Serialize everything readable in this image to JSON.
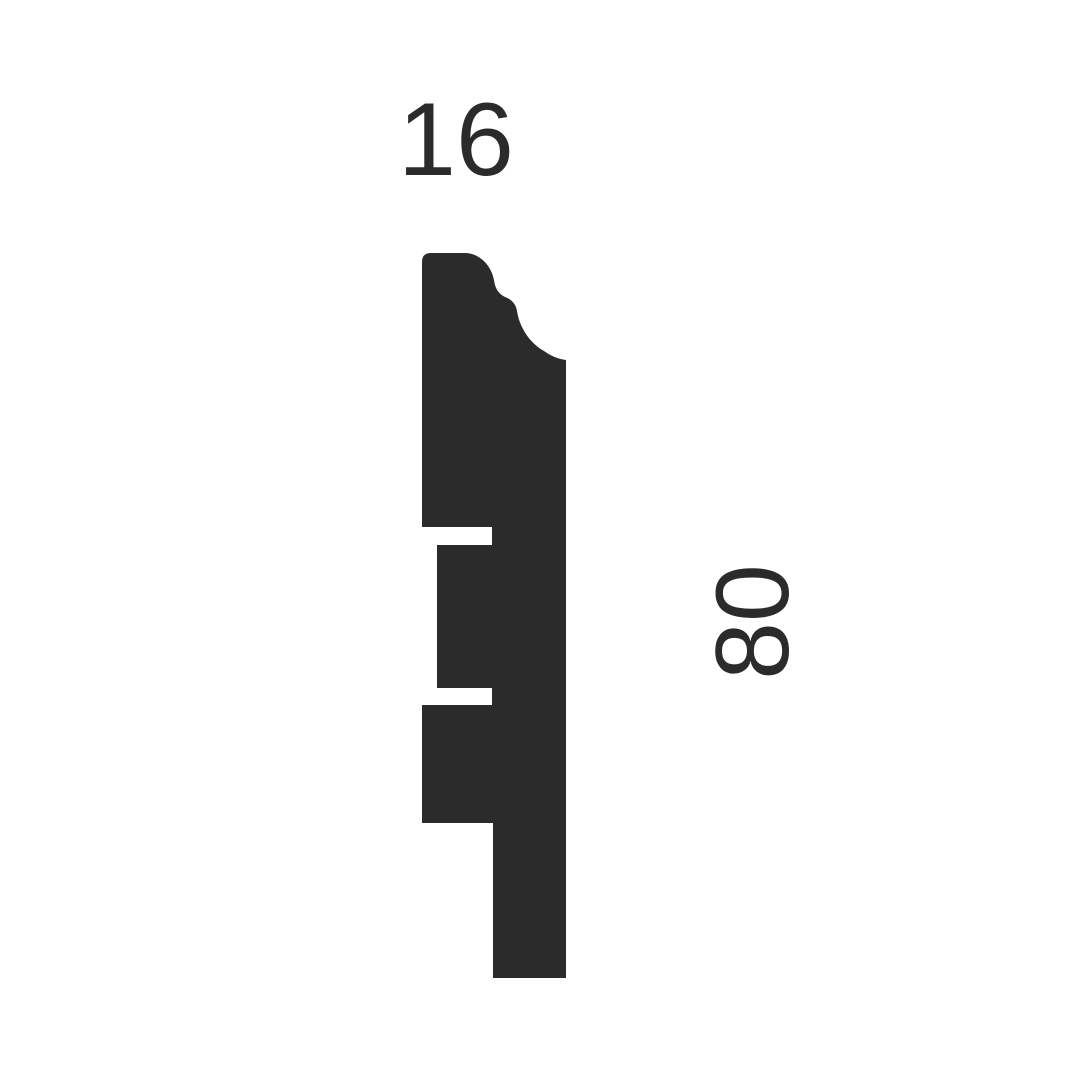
{
  "canvas": {
    "width_px": 1080,
    "height_px": 1080,
    "background_color": "#ffffff"
  },
  "diagram": {
    "type": "moulding-profile-cross-section",
    "shape_color": "#2b2b2b",
    "text_color": "#2b2b2b",
    "profile_path": "M422 262 Q422 253 431 253 L466 253 C480 254 491 265 494 280 C495 289 499 294 505 297 C511 299 516 304 517 311 C519 325 528 342 544 351 C551 356 558 359 566 360 L566 978 L493 978 L493 823 L422 823 L422 705 L492 705 L492 688 L437 688 L437 545 L492 545 L492 527 L422 527 Z",
    "dimensions": {
      "width": {
        "value": "16",
        "placement": "top"
      },
      "height": {
        "value": "80",
        "placement": "right",
        "rotation_deg": -90
      }
    }
  }
}
